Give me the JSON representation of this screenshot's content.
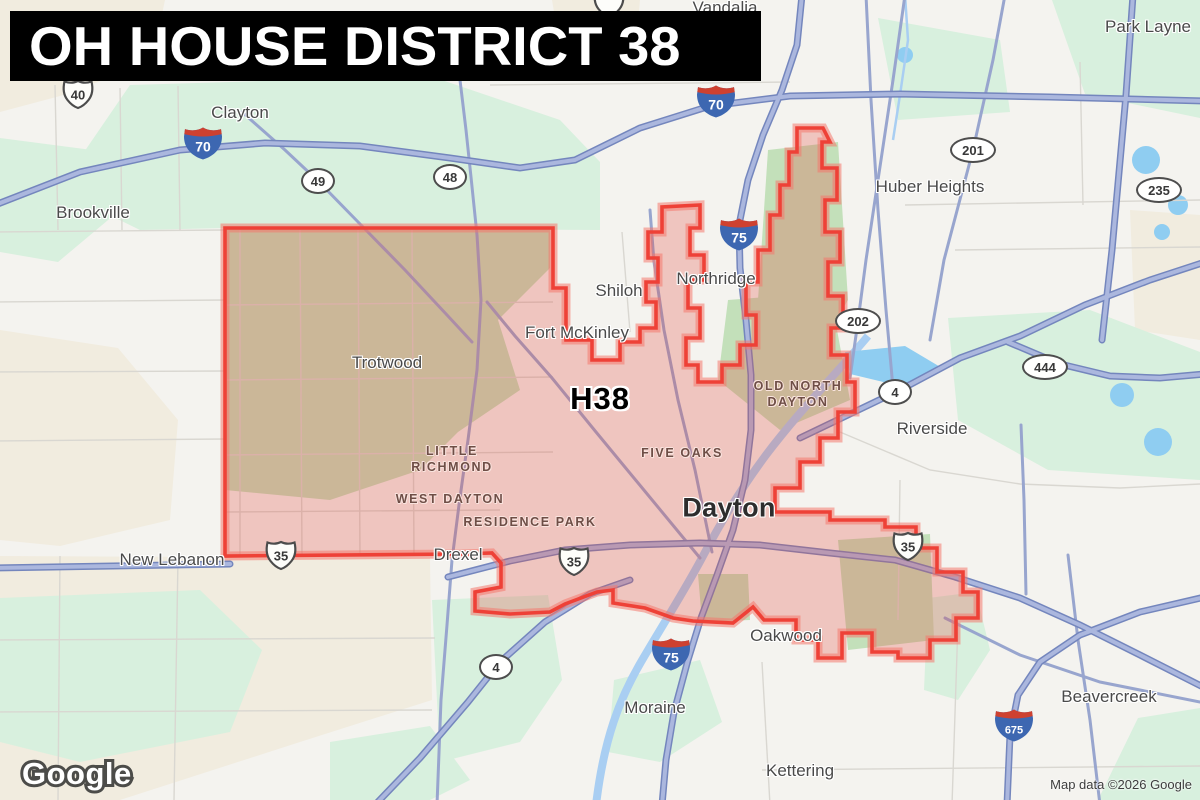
{
  "banner": {
    "title": "OH HOUSE DISTRICT 38"
  },
  "district": {
    "label": "H38",
    "stroke_color": "#ee4137",
    "fill_color": "rgba(227,74,64,0.27)"
  },
  "attribution": {
    "logo": "Google",
    "map_data": "Map data ©2026 Google"
  },
  "labels": {
    "cities": [
      {
        "text": "Vandalia",
        "x": 725,
        "y": 8
      },
      {
        "text": "Park Layne",
        "x": 1148,
        "y": 27
      },
      {
        "text": "Clayton",
        "x": 240,
        "y": 113
      },
      {
        "text": "Brookville",
        "x": 93,
        "y": 213
      },
      {
        "text": "Huber Heights",
        "x": 930,
        "y": 187
      },
      {
        "text": "Shiloh",
        "x": 619,
        "y": 291
      },
      {
        "text": "Northridge",
        "x": 716,
        "y": 279
      },
      {
        "text": "Fort McKinley",
        "x": 577,
        "y": 333
      },
      {
        "text": "Trotwood",
        "x": 387,
        "y": 363
      },
      {
        "text": "Riverside",
        "x": 932,
        "y": 429
      },
      {
        "text": "New Lebanon",
        "x": 172,
        "y": 560
      },
      {
        "text": "Drexel",
        "x": 458,
        "y": 555
      },
      {
        "text": "Dayton",
        "x": 729,
        "y": 508,
        "major": true
      },
      {
        "text": "Oakwood",
        "x": 786,
        "y": 636
      },
      {
        "text": "Moraine",
        "x": 655,
        "y": 708
      },
      {
        "text": "Kettering",
        "x": 800,
        "y": 771
      },
      {
        "text": "Beavercreek",
        "x": 1109,
        "y": 697
      }
    ],
    "neighborhoods": [
      {
        "lines": [
          "LITTLE",
          "RICHMOND"
        ],
        "x": 452,
        "y": 459
      },
      {
        "lines": [
          "WEST DAYTON"
        ],
        "x": 450,
        "y": 499
      },
      {
        "lines": [
          "RESIDENCE PARK"
        ],
        "x": 530,
        "y": 522
      },
      {
        "lines": [
          "FIVE OAKS"
        ],
        "x": 682,
        "y": 453
      },
      {
        "lines": [
          "OLD NORTH",
          "DAYTON"
        ],
        "x": 798,
        "y": 394
      }
    ]
  },
  "shields": {
    "interstate": [
      {
        "num": "70",
        "x": 203,
        "y": 146
      },
      {
        "num": "70",
        "x": 716,
        "y": 104
      },
      {
        "num": "75",
        "x": 739,
        "y": 237
      },
      {
        "num": "75",
        "x": 671,
        "y": 657
      },
      {
        "num": "675",
        "x": 1014,
        "y": 728
      }
    ],
    "us_routes": [
      {
        "num": "40",
        "x": 78,
        "y": 97
      },
      {
        "num": "",
        "x": 609,
        "y": 6
      },
      {
        "num": "35",
        "x": 281,
        "y": 558
      },
      {
        "num": "35",
        "x": 574,
        "y": 564
      },
      {
        "num": "35",
        "x": 908,
        "y": 549
      }
    ],
    "state_routes": [
      {
        "num": "49",
        "x": 318,
        "y": 181
      },
      {
        "num": "48",
        "x": 450,
        "y": 177
      },
      {
        "num": "201",
        "x": 973,
        "y": 150
      },
      {
        "num": "235",
        "x": 1159,
        "y": 190
      },
      {
        "num": "202",
        "x": 858,
        "y": 321
      },
      {
        "num": "4",
        "x": 895,
        "y": 392
      },
      {
        "num": "444",
        "x": 1045,
        "y": 367
      },
      {
        "num": "4",
        "x": 496,
        "y": 667
      }
    ]
  }
}
